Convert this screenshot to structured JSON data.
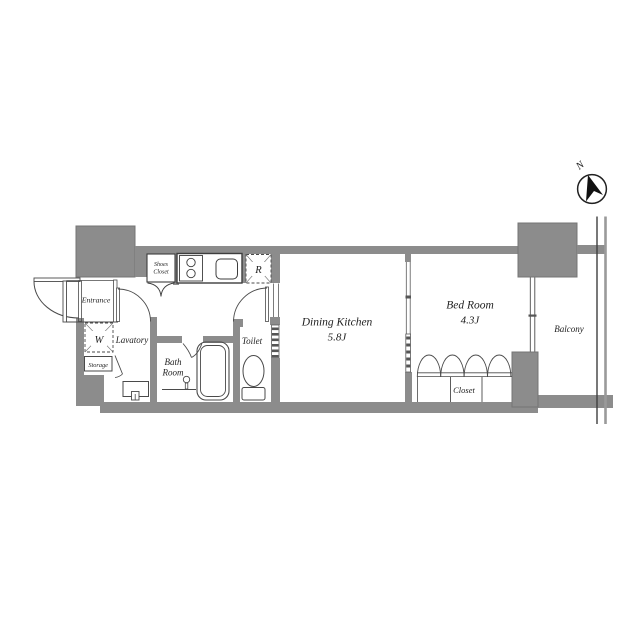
{
  "title": "Apartment floor plan (1DK)",
  "colors": {
    "background": "#ffffff",
    "wall_fill": "#8c8c8c",
    "wall_edge": "#757575",
    "line": "#4a4a4a",
    "text": "#1f1f1f",
    "arrow": "#111111"
  },
  "compass": {
    "label": "N"
  },
  "rooms": {
    "entrance": {
      "label": "Entrance"
    },
    "lavatory": {
      "label": "Lavatory"
    },
    "storage": {
      "label": "Storage"
    },
    "washing_machine": {
      "label": "W"
    },
    "shoes_closet": {
      "label_line1": "Shoes",
      "label_line2": "Closet"
    },
    "refrigerator": {
      "label": "R"
    },
    "bath_room": {
      "label_line1": "Bath",
      "label_line2": "Room"
    },
    "toilet": {
      "label": "Toilet"
    },
    "dining_kitchen": {
      "label": "Dining Kitchen",
      "size": "5.8J"
    },
    "bed_room": {
      "label": "Bed Room",
      "size": "4.3J"
    },
    "closet": {
      "label": "Closet"
    },
    "balcony": {
      "label": "Balcony"
    }
  }
}
